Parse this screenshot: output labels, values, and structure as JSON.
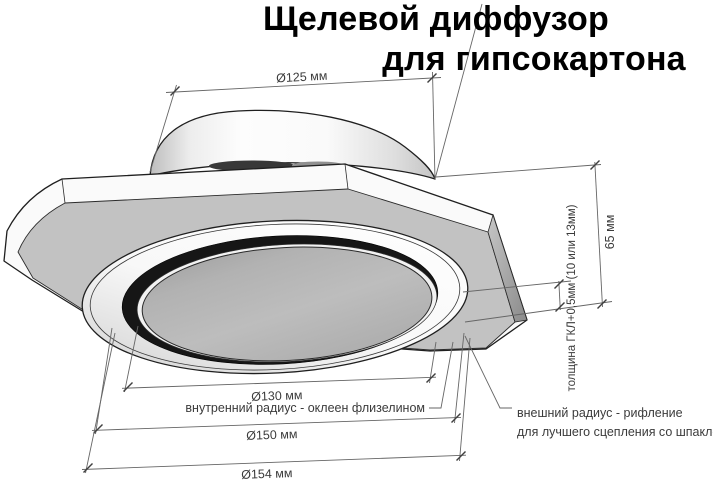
{
  "title": {
    "line1": "Щелевой диффузор",
    "line2": "для гипсокартона"
  },
  "dimensions": {
    "top_diameter": "Ø125 мм",
    "height": "65 мм",
    "gypsum_thickness": "толщина ГКЛ+0,5мм (10 или 13мм)",
    "inner_diameter": "Ø130 мм",
    "ring_diameter": "Ø150 мм",
    "outer_diameter": "Ø154 мм"
  },
  "annotations": {
    "inner_radius": "внутренний радиус - оклеен флизелином",
    "outer_radius_line1": "внешний радиус - рифление",
    "outer_radius_line2": "для лучшего сцепления со шпаклёвкой"
  },
  "colors": {
    "background": "#ffffff",
    "outline": "#1f1f1f",
    "dimension_line": "#666666",
    "dimension_text": "#3b3b3b",
    "title_text": "#000000",
    "plate_gray": "#c2c2c2",
    "inner_disc_gray": "#b5b5b5",
    "slot_dark": "#161616",
    "collar_white": "#fbfbfb"
  }
}
